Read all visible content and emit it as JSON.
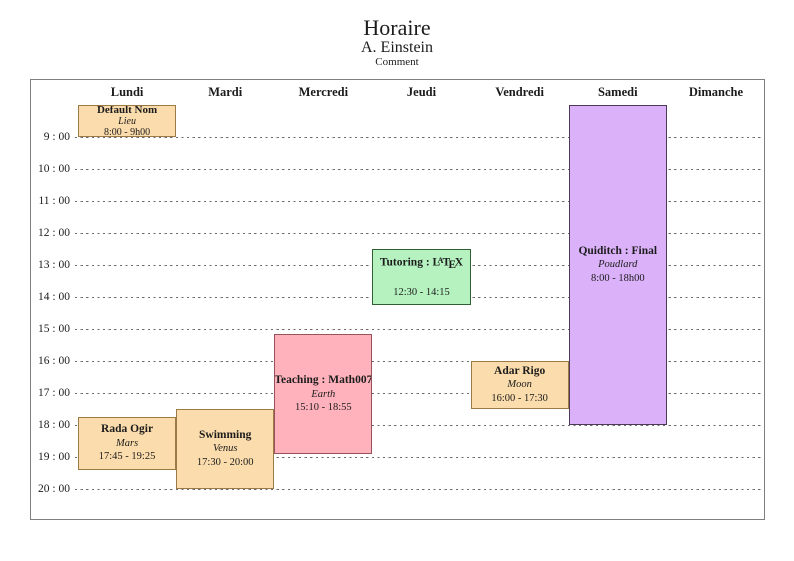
{
  "header": {
    "title": "Horaire",
    "subtitle": "A. Einstein",
    "comment": "Comment"
  },
  "days": [
    "Lundi",
    "Mardi",
    "Mercredi",
    "Jeudi",
    "Vendredi",
    "Samedi",
    "Dimanche"
  ],
  "hours": [
    "9 : 00",
    "10 : 00",
    "11 : 00",
    "12 : 00",
    "13 : 00",
    "14 : 00",
    "15 : 00",
    "16 : 00",
    "17 : 00",
    "18 : 00",
    "19 : 00",
    "20 : 00"
  ],
  "colors": {
    "peach_fill": "#fbdcac",
    "peach_border": "#9c7a45",
    "pink_fill": "#ffb2bc",
    "pink_border": "#96535c",
    "green_fill": "#b5f2bf",
    "green_border": "#2f5f33",
    "purple_fill": "#dbb2f9",
    "purple_border": "#4e3a56",
    "grid_line": "#6a6a6a",
    "frame_border": "#7f7f7f"
  },
  "events": [
    {
      "name": "default-nom",
      "title": "Default Nom",
      "location": "Lieu",
      "time": "8:00 - 9h00",
      "day_label": "Lundi",
      "day": 0,
      "start": 8.0,
      "end": 9.0,
      "color": "peach"
    },
    {
      "name": "rada-ogir",
      "title": "Rada Ogir",
      "location": "Mars",
      "time": "17:45 - 19:25",
      "day_label": "Lundi",
      "day": 0,
      "start": 17.75,
      "end": 19.4167,
      "color": "peach"
    },
    {
      "name": "swimming",
      "title": "Swimming",
      "location": "Venus",
      "time": "17:30 - 20:00",
      "day_label": "Mardi",
      "day": 1,
      "start": 17.5,
      "end": 20.0,
      "color": "peach"
    },
    {
      "name": "teaching-math007",
      "title": "Teaching : Math007",
      "location": "Earth",
      "time": "15:10 - 18:55",
      "day_label": "Mercredi",
      "day": 2,
      "start": 15.1667,
      "end": 18.9167,
      "color": "pink"
    },
    {
      "name": "tutoring-latex",
      "title": "Tutoring : LaTeX",
      "location": "",
      "time": "12:30 - 14:15",
      "day_label": "Jeudi",
      "day": 3,
      "start": 12.5,
      "end": 14.25,
      "color": "green",
      "latex_parts": [
        {
          "t": "Tutoring : L",
          "s": "n"
        },
        {
          "t": "A",
          "s": "sup"
        },
        {
          "t": "T",
          "s": "n"
        },
        {
          "t": "E",
          "s": "sub"
        },
        {
          "t": "X",
          "s": "n"
        }
      ]
    },
    {
      "name": "adar-rigo",
      "title": "Adar Rigo",
      "location": "Moon",
      "time": "16:00 - 17:30",
      "day_label": "Vendredi",
      "day": 4,
      "start": 16.0,
      "end": 17.5,
      "color": "peach"
    },
    {
      "name": "quiditch-final",
      "title": "Quiditch : Final",
      "location": "Poudlard",
      "time": "8:00 - 18h00",
      "day_label": "Samedi",
      "day": 5,
      "start": 8.0,
      "end": 18.0,
      "color": "purple"
    }
  ]
}
